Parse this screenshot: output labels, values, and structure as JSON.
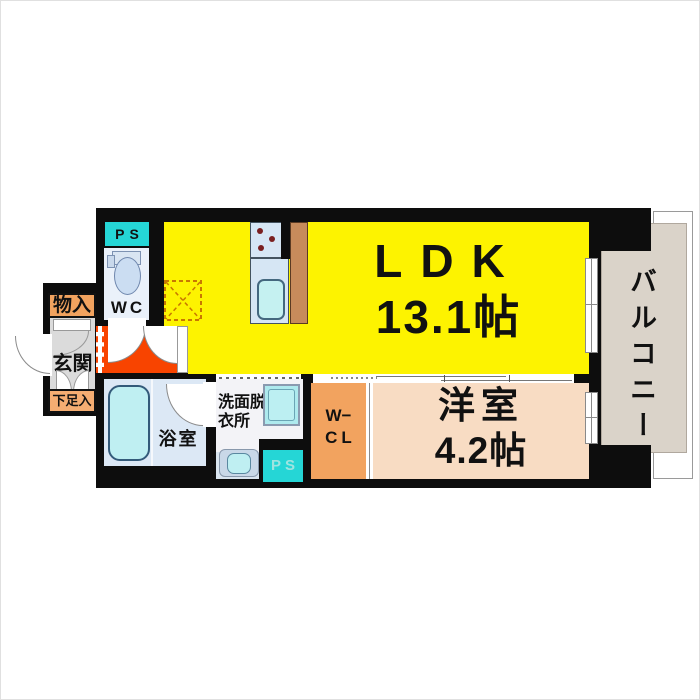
{
  "floor_plan": {
    "rooms": {
      "ldk": {
        "label": "LDK",
        "size": "13.1帖"
      },
      "western_room": {
        "label": "洋室",
        "size": "4.2帖"
      },
      "balcony": {
        "label": "バルコニー"
      },
      "entrance": {
        "label": "玄関"
      },
      "storage": {
        "label": "物入"
      },
      "shoe_storage": {
        "label": "下足入"
      },
      "toilet": {
        "label": "WC"
      },
      "bathroom": {
        "label": "浴室"
      },
      "washroom": {
        "label_line1": "洗面脱",
        "label_line2": "衣所"
      },
      "walk_in_closet": {
        "label_line1": "W−",
        "label_line2": "CL"
      },
      "pipe_space_top": {
        "label": "PS"
      },
      "pipe_space_bottom": {
        "label": "PS"
      }
    },
    "colors": {
      "wall": "#0d0d0d",
      "ldk_yellow": "#fdf300",
      "hall_red": "#f84400",
      "storage_orange": "#f2a35f",
      "shoe_storage_orange": "#f5ad72",
      "western_room_peach": "#f8dcc3",
      "balcony_beige": "#dad3c9",
      "pipe_space_cyan": "#25d6d6",
      "wet_area_blue": "#dce8f5",
      "fixture_cyan": "#bfeff2",
      "entrance_gray": "#dbdbdb",
      "kitchen_counter_blue": "#d6e6f4",
      "fridge_brown": "#c78b5b"
    }
  }
}
